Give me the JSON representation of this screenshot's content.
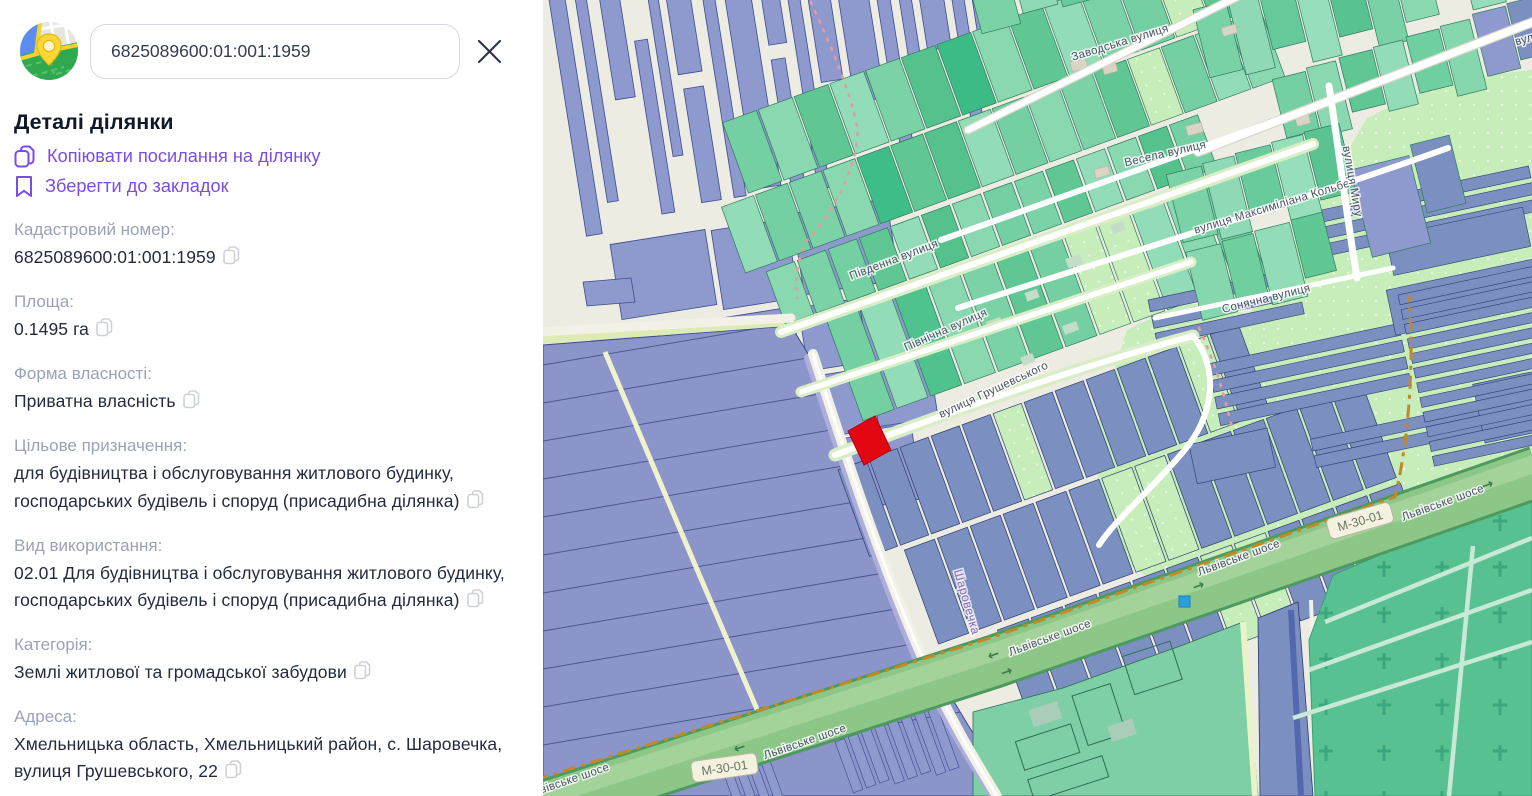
{
  "panel": {
    "search_value": "6825089600:01:001:1959",
    "title": "Деталі ділянки",
    "actions": {
      "copy_link": "Копіювати посилання на ділянку",
      "bookmark": "Зберегти до закладок"
    },
    "fields": [
      {
        "label": "Кадастровий номер:",
        "value": "6825089600:01:001:1959"
      },
      {
        "label": "Площа:",
        "value": "0.1495 га"
      },
      {
        "label": "Форма власності:",
        "value": "Приватна власність"
      },
      {
        "label": "Цільове призначення:",
        "value": "для будівництва і обслуговування житлового будинку, господарських будівель і споруд (присадибна ділянка)"
      },
      {
        "label": "Вид використання:",
        "value": "02.01 Для будівництва і обслуговування житлового будинку, господарських будівель і споруд (присадибна ділянка)"
      },
      {
        "label": "Категорія:",
        "value": "Землі житлової та громадської забудови"
      },
      {
        "label": "Адреса:",
        "value": "Хмельницька область, Хмельницький район, с. Шаровечка, вулиця Грушевського, 22"
      }
    ]
  },
  "map": {
    "selected_parcel_color": "#e30613",
    "marker_color": "#2aa0db",
    "street_labels": [
      {
        "text": "Заводська вулиця",
        "x": 578,
        "y": 46,
        "r": -17
      },
      {
        "text": "вулиця",
        "x": 992,
        "y": 40,
        "r": -16
      },
      {
        "text": "Весела вулиця",
        "x": 623,
        "y": 157,
        "r": -13
      },
      {
        "text": "вулиця Максиміліана Кольбе",
        "x": 730,
        "y": 210,
        "r": -17
      },
      {
        "text": "вулиця Миру",
        "x": 806,
        "y": 182,
        "r": 80
      },
      {
        "text": "Південна вулиця",
        "x": 352,
        "y": 263,
        "r": -21
      },
      {
        "text": "Північна вулиця",
        "x": 404,
        "y": 333,
        "r": -24
      },
      {
        "text": "Сонячна вулиця",
        "x": 724,
        "y": 302,
        "r": -14
      },
      {
        "text": "вулиця Грушевського",
        "x": 452,
        "y": 393,
        "r": -25
      },
      {
        "text": "Шаровечка",
        "x": 420,
        "y": 603,
        "r": 74,
        "color": "#8d6cb8",
        "size": 12.5
      },
      {
        "text": "Львівське шосе",
        "x": 697,
        "y": 561,
        "r": -20
      },
      {
        "text": "Львівське шосе",
        "x": 508,
        "y": 641,
        "r": -20
      },
      {
        "text": "Львівське шосе",
        "x": 263,
        "y": 745,
        "r": -19
      },
      {
        "text": "Львівське шосе",
        "x": 901,
        "y": 506,
        "r": -20
      },
      {
        "text": "Львівське шосе",
        "x": 26,
        "y": 784,
        "r": -19
      }
    ],
    "route_badges": [
      {
        "text": "М-30-01",
        "x": 182,
        "y": 771,
        "r": -8
      },
      {
        "text": "М-30-01",
        "x": 818,
        "y": 524,
        "r": -16
      }
    ],
    "arrows": [
      {
        "glyph": "←",
        "x": 452,
        "y": 659,
        "r": -19
      },
      {
        "glyph": "→",
        "x": 465,
        "y": 676,
        "r": -19
      },
      {
        "glyph": "→",
        "x": 657,
        "y": 590,
        "r": -20
      },
      {
        "glyph": "→",
        "x": 946,
        "y": 489,
        "r": -20
      },
      {
        "glyph": "←",
        "x": 198,
        "y": 752,
        "r": -19
      }
    ]
  },
  "colors": {
    "accent": "#7a4ce8",
    "label_gray": "#9aa3b6",
    "value_dark": "#222c3e"
  }
}
